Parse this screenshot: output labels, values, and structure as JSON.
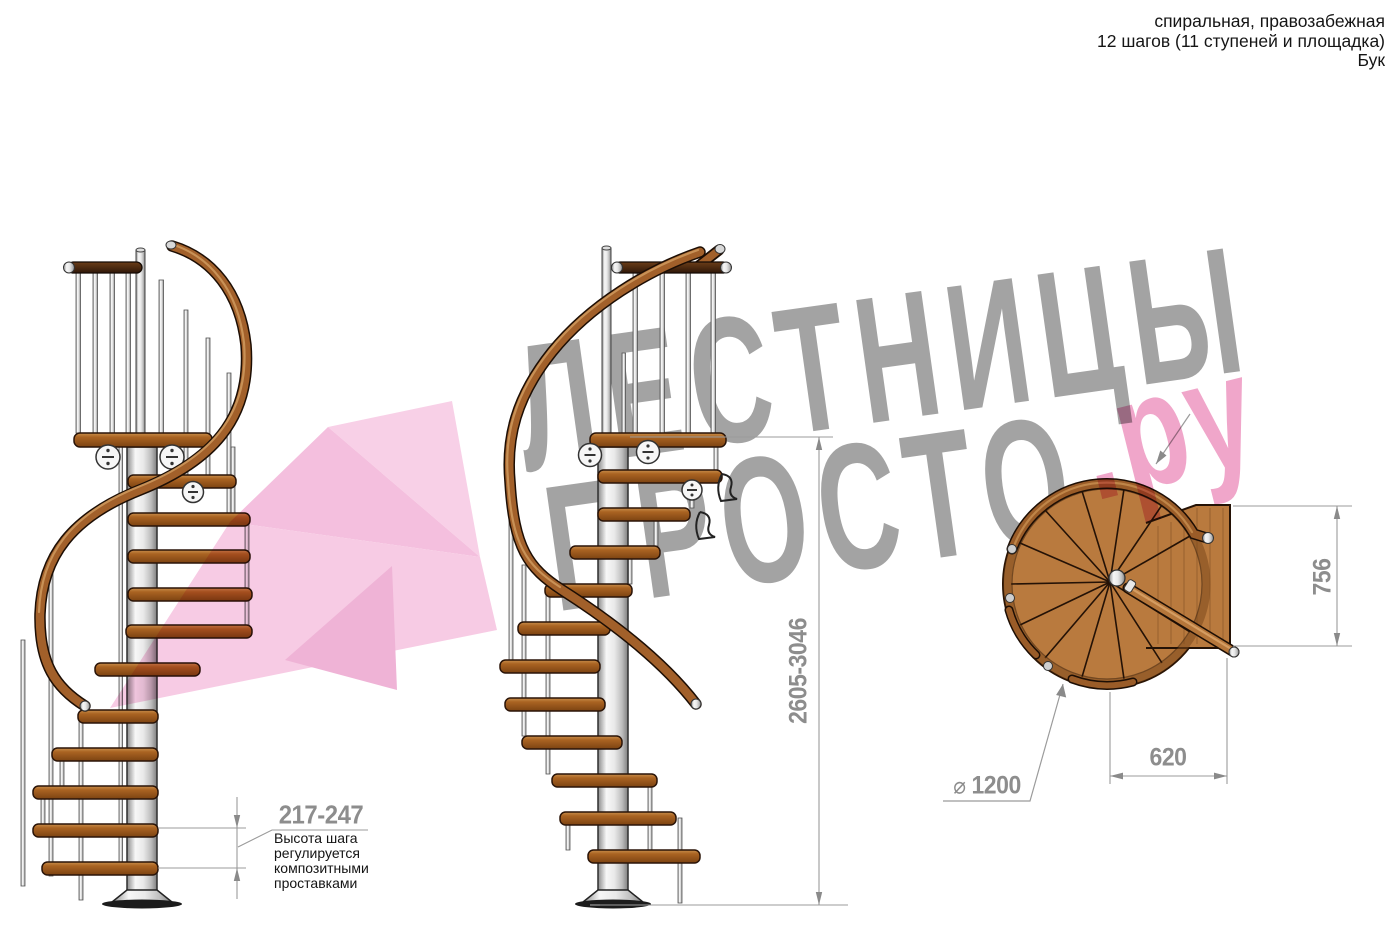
{
  "title_block": {
    "line1": "спиральная, правозабежная",
    "line2": "12 шагов (11 ступеней и площадка)",
    "line3": "Бук"
  },
  "watermark": {
    "word1": "ЛЕСТНИЦЫ",
    "word2": "ПРОСТО",
    "domain_suffix": ".ру",
    "gray": "#9c9c9c",
    "pink": "#ef9cc4",
    "arrow_pink": "#f3b7d9"
  },
  "dimensions": {
    "step_height": "217-247",
    "step_height_note_line1": "Высота шага",
    "step_height_note_line2": "регулируется",
    "step_height_note_line3": "композитными",
    "step_height_note_line4": "проставками",
    "total_height": "2605-3046",
    "landing_depth": "756",
    "landing_width": "620",
    "diameter_symbol": "⌀",
    "diameter": "1200"
  },
  "colors": {
    "wood": "#b56d2e",
    "wood_dark": "#6e3a10",
    "rail": "#a2602a",
    "metal_light": "#f2f2f2",
    "metal_dark": "#7d7d7d",
    "dimension_gray": "#8d8d8d"
  }
}
